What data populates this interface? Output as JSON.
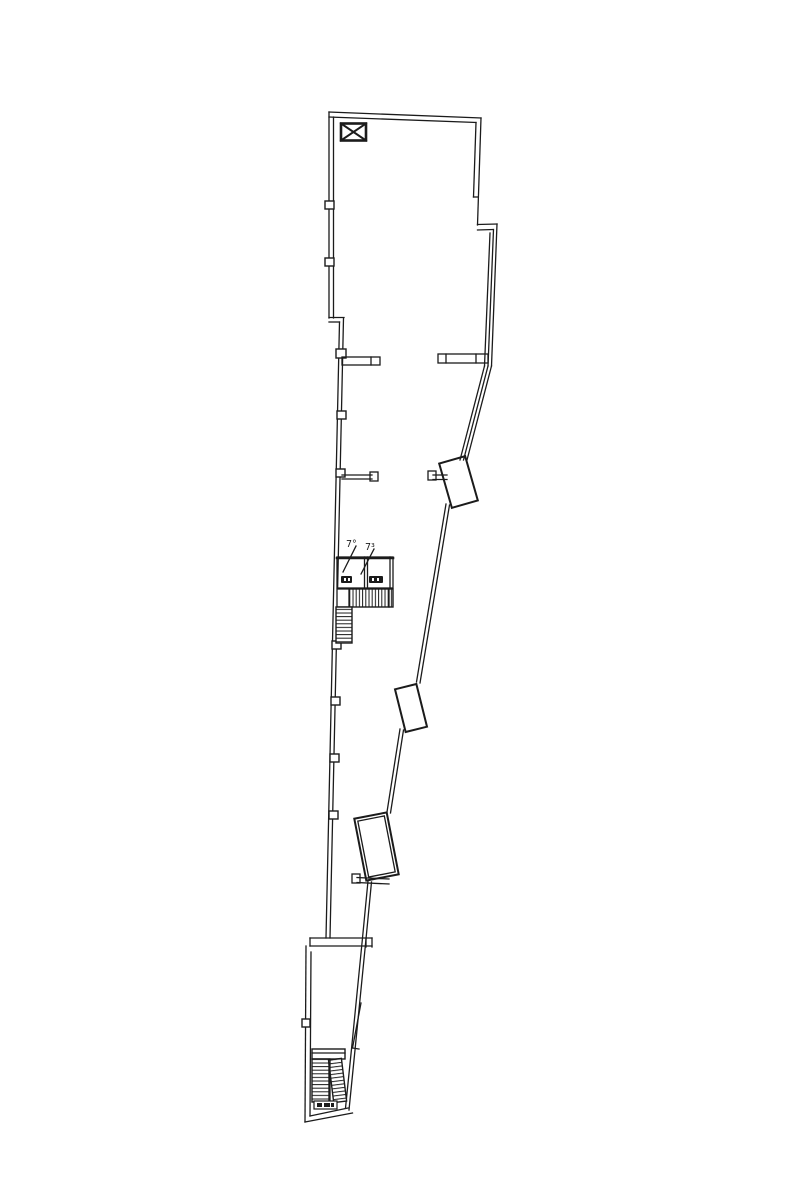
{
  "canvas": {
    "width": 800,
    "height": 1200
  },
  "colors": {
    "line": "#1b1b1b",
    "background": "#ffffff"
  },
  "labels": {
    "room_left": "7°",
    "room_right": "7³"
  },
  "icons": [
    {
      "name": "column-marker-icon",
      "shape": "crossed-box"
    },
    {
      "name": "stair-run-icon",
      "shape": "hatched-bar"
    },
    {
      "name": "wall-node-icon",
      "shape": "small-square"
    }
  ]
}
